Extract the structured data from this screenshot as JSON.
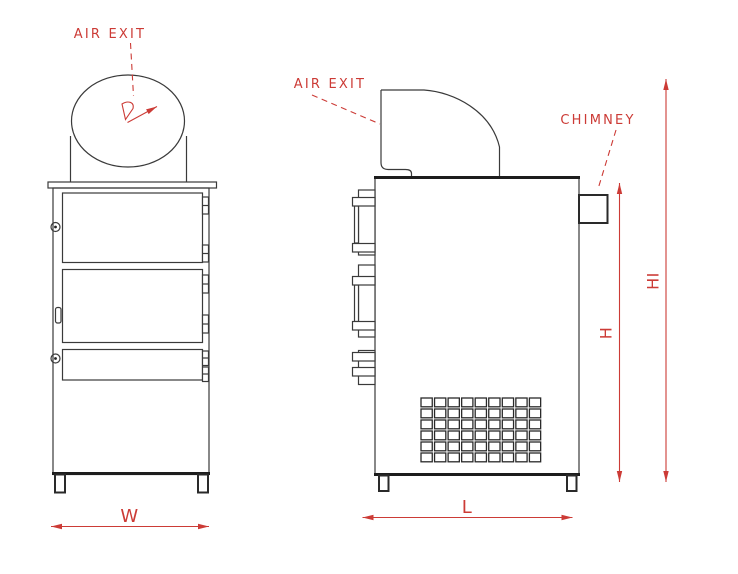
{
  "colors": {
    "annotation_red": "#cc3b36",
    "line_dark": "#3a3a3a"
  },
  "front_view": {
    "air_exit_label": "AIR EXIT",
    "width_dim_label": "W"
  },
  "side_view": {
    "air_exit_label": "AIR EXIT",
    "chimney_label": "CHIMNEY",
    "length_dim_label": "L",
    "height_dim_label": "H",
    "overall_height_dim_label": "HI",
    "grille": {
      "rows": 6,
      "cols": 9
    }
  }
}
